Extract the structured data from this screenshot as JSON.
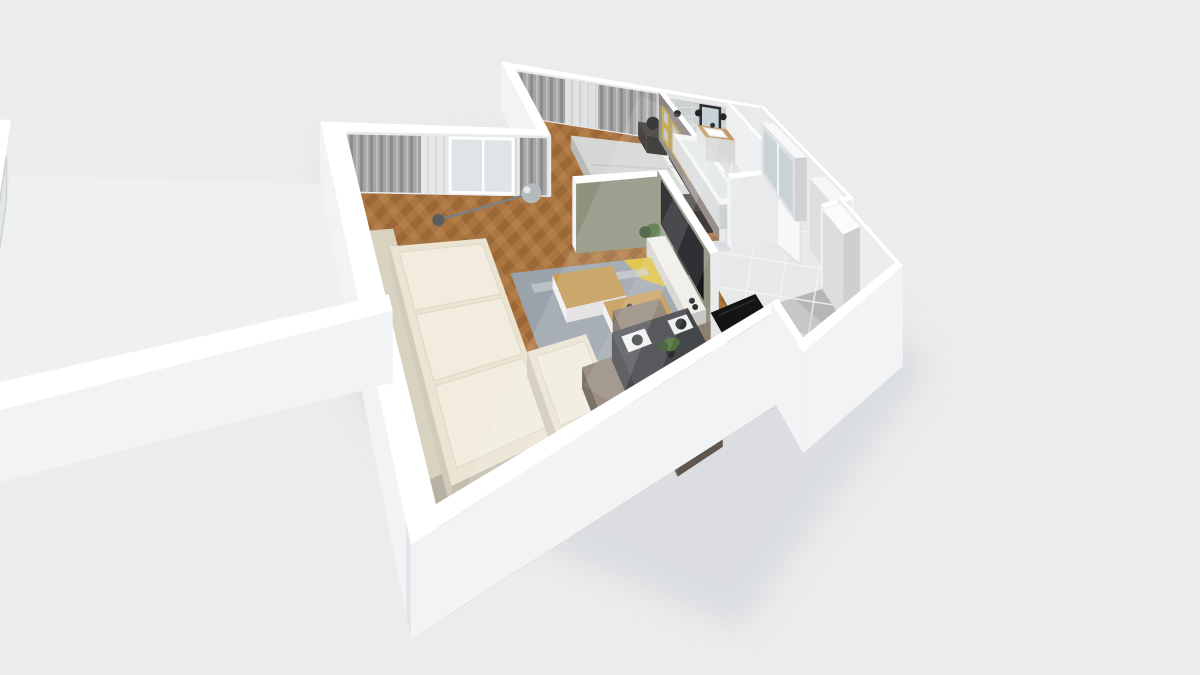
{
  "scene": {
    "kind": "isometric-3d-apartment-floorplan-render",
    "rooms": [
      {
        "name": "living-room",
        "floor": "herringbone-wood"
      },
      {
        "name": "bedroom",
        "floor": "herringbone-wood"
      },
      {
        "name": "bathroom",
        "floor": "light-tile"
      },
      {
        "name": "hallway",
        "floor": "white-tile"
      },
      {
        "name": "kitchen",
        "floor": "gray-tile"
      },
      {
        "name": "balcony",
        "floor": "white-slab"
      }
    ],
    "furniture": [
      "bed",
      "headboard",
      "pillow",
      "nightstand",
      "bedside-lamp",
      "wall-art-frame",
      "curtains",
      "sheer-curtain",
      "balcony-door",
      "floor-lamp",
      "sofa",
      "sofa-cushion",
      "area-rug",
      "coffee-table",
      "dining-table",
      "dining-chair",
      "place-setting",
      "table-plant",
      "tv-wall",
      "tv-screen",
      "tv-console",
      "potted-plant",
      "bathtub",
      "shower-head",
      "vanity",
      "sink",
      "mirror",
      "wall-sconce",
      "washing-machine",
      "bathroom-door",
      "wardrobe",
      "wardrobe-mirror",
      "entry-column",
      "fridge-column",
      "kitchen-counter",
      "cooktop",
      "kitchen-sink",
      "faucet",
      "apple-bowl",
      "cutting-board",
      "spice-bottles",
      "kitchen-island",
      "herb-pot",
      "white-box"
    ]
  },
  "colors": {
    "bg": "#ececed",
    "shadow": "#d7dade",
    "wallTop": "#ffffff",
    "wallInner": "#e9eaec",
    "wallOuter": "#f2f3f5",
    "wallOuterShade": "#e3e5e8",
    "woodA": "#aa7440",
    "woodB": "#8d5c30",
    "woodC": "#c28f55",
    "kitchenTile": "#b5b7b6",
    "kitchenTileLight": "#d3d5d4",
    "bathFloor": "#dfe1e1",
    "hallTile": "#e7e8e8",
    "grout": "#f4f5f5",
    "subway": "#ccd0d1",
    "olive": "#8e937f",
    "taupe": "#8d8381",
    "curtain": "#a3a5a6",
    "curtainDark": "#8a8c8e",
    "sheer": "#e6e8e9",
    "glass": "#dfe4e6",
    "bedding": "#d6d6d5",
    "pillow": "#f0f0ef",
    "headboard": "#242527",
    "nightstand": "#3a3633",
    "lampBlack": "#1c1d1f",
    "gold": "#c2a23c",
    "artSky": "#b9c3cc",
    "sofa": "#eae4d3",
    "sofaShade": "#d8d2c0",
    "cushion": "#f1ecdd",
    "rug": "#9aa2ab",
    "rugLight": "#c9cdd2",
    "rugYellow": "#dfc134",
    "rugDark": "#3c4249",
    "tableWood": "#c59a55",
    "diningTable": "#44474a",
    "diningSide": "#393c3f",
    "chair": "#8d7f71",
    "plate": "#2f3234",
    "placemat": "#eff0f0",
    "tv": "#17191c",
    "console": "#efeeea",
    "counterWood": "#c49a62",
    "counterFront": "#f0f0ee",
    "cooktop": "#1a1c1e",
    "burner": "#2a2d2f",
    "burnerRing": "#7a7e81",
    "sinkGray": "#9aa0a1",
    "sinkInner": "#8b9192",
    "apple": "#6fae3a",
    "bowl": "#2e3133",
    "fridge": "#fbfbfc",
    "island": "#121416",
    "islandSide": "#f4f4f4",
    "plant": "#51713f",
    "plantDark": "#3c5630",
    "pot": "#2c2e30",
    "lampSilver": "#b7babd",
    "lampStem": "#7d8083",
    "tub": "#f4f6f6",
    "tubInner": "#e2e7e8",
    "washer": "#f2f3f3",
    "washerDoor": "#3a3d40",
    "mirror": "#c8d2d6",
    "mirrorFrame": "#2b2d2f",
    "doorLeaf": "#f6f7f8",
    "board": "#a87c44",
    "bottle": "#3a2d22",
    "lightBeam": "#ffffff"
  }
}
